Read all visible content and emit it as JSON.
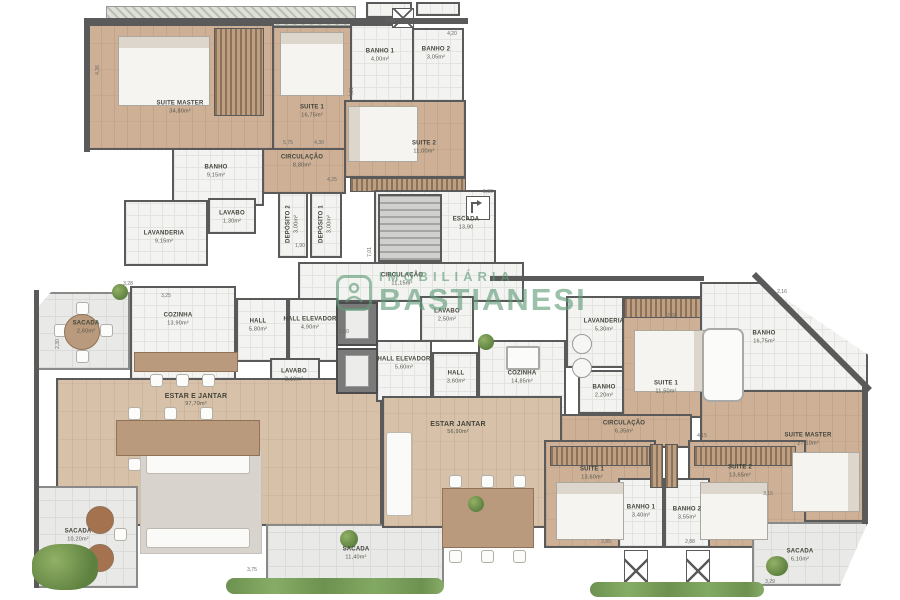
{
  "watermark": {
    "line1": "IMOBILIÁRIA",
    "line2": "BASTIANESI"
  },
  "colors": {
    "wall": "#5a5a5a",
    "wood": "#cdb096",
    "wood_light": "#d7c2a9",
    "tile": "#f3f3f1",
    "terrace": "#e9e9e7",
    "watermark_green": "#5f9c79",
    "plant_green": "#6d9150"
  },
  "rooms": {
    "suiteMasterU": {
      "name": "SUITE MASTER",
      "area": "34,80m²"
    },
    "suite1U": {
      "name": "SUITE 1",
      "area": "16,75m²"
    },
    "banho1U": {
      "name": "BANHO 1",
      "area": "4,00m²"
    },
    "banho2U": {
      "name": "BANHO 2",
      "area": "3,05m²"
    },
    "suite2U": {
      "name": "SUITE 2",
      "area": "11,00m²"
    },
    "banhoU": {
      "name": "BANHO",
      "area": "9,15m²"
    },
    "circU": {
      "name": "CIRCULAÇÃO",
      "area": "8,80m²"
    },
    "lavaboU": {
      "name": "LAVABO",
      "area": "1,30m²"
    },
    "lavanderiaU": {
      "name": "LAVANDERIA",
      "area": "9,15m²"
    },
    "deposito1": {
      "name": "DEPÓSITO 1",
      "area": "3,00m²"
    },
    "deposito2": {
      "name": "DEPÓSITO 2",
      "area": "3,00m²"
    },
    "escada": {
      "name": "ESCADA",
      "area": "13,90"
    },
    "circCore": {
      "name": "CIRCULAÇÃO",
      "area": "11,15m²"
    },
    "sacadaU": {
      "name": "SACADA",
      "area": "2,60m²"
    },
    "cozinhaU": {
      "name": "COZINHA",
      "area": "13,90m²"
    },
    "hallU": {
      "name": "HALL",
      "area": "5,80m²"
    },
    "hallElevU": {
      "name": "HALL ELEVADOR",
      "area": "4,90m²"
    },
    "lavabo2U": {
      "name": "LAVABO",
      "area": "2,10m²"
    },
    "estarU": {
      "name": "ESTAR E JANTAR",
      "area": "97,70m²"
    },
    "sacadaSW": {
      "name": "SACADA",
      "area": "10,20m²"
    },
    "lavaboL": {
      "name": "LAVABO",
      "area": "2,50m²"
    },
    "hallElevL": {
      "name": "HALL ELEVADOR",
      "area": "5,60m²"
    },
    "hallL": {
      "name": "HALL",
      "area": "3,60m²"
    },
    "cozinhaL": {
      "name": "COZINHA",
      "area": "14,85m²"
    },
    "lavanderiaL": {
      "name": "LAVANDERIA",
      "area": "5,30m²"
    },
    "banhoL": {
      "name": "BANHO",
      "area": "2,20m²"
    },
    "suite1L": {
      "name": "SUITE 1",
      "area": "11,50m²"
    },
    "banhoML": {
      "name": "BANHO",
      "area": "16,75m²"
    },
    "suiteMasterL": {
      "name": "SUITE MASTER",
      "area": "27,10m²"
    },
    "estarL": {
      "name": "ESTAR JANTAR",
      "area": "56,90m²"
    },
    "circL": {
      "name": "CIRCULAÇÃO",
      "area": "6,35m²"
    },
    "suite1B": {
      "name": "SUITE 1",
      "area": "13,60m²"
    },
    "suite2B": {
      "name": "SUITE 2",
      "area": "13,65m²"
    },
    "banho1B": {
      "name": "BANHO 1",
      "area": "3,40m²"
    },
    "banho2B": {
      "name": "BANHO 2",
      "area": "3,55m²"
    },
    "sacadaS": {
      "name": "SACADA",
      "area": "11,40m²"
    },
    "sacadaSE": {
      "name": "SACADA",
      "area": "6,10m²"
    }
  },
  "dims": [
    "4,36",
    "5,75",
    "4,30",
    "4,21",
    "2,80",
    "4,20",
    "2,16",
    "5,30",
    "1,90",
    "3,28",
    "3,25",
    "2,30",
    "1,50",
    "7,01",
    "4,25",
    "2,85",
    "2,88",
    "4,15",
    "3,15",
    "3,29",
    "3,75",
    "2,68"
  ]
}
